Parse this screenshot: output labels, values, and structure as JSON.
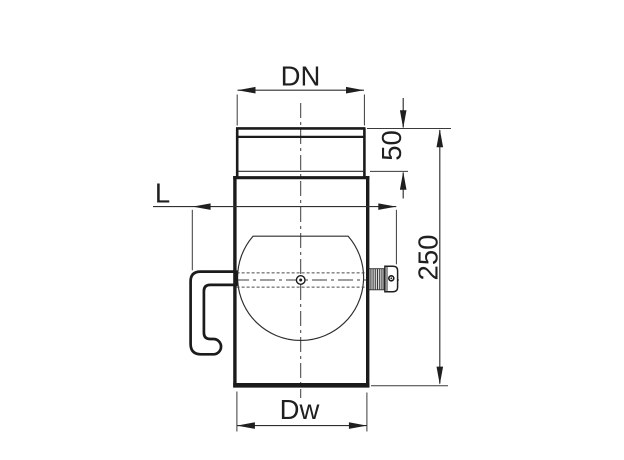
{
  "drawing": {
    "background": "#ffffff",
    "outline_color": "#1b1b1b",
    "dim_line_color": "#2f2f2f",
    "thread_fill": "#d8d8d8",
    "labels": {
      "socket_diameter": "DN",
      "socket_depth": "50",
      "handle_span": "L",
      "overall_length": "250",
      "body_diameter": "Dw"
    }
  }
}
